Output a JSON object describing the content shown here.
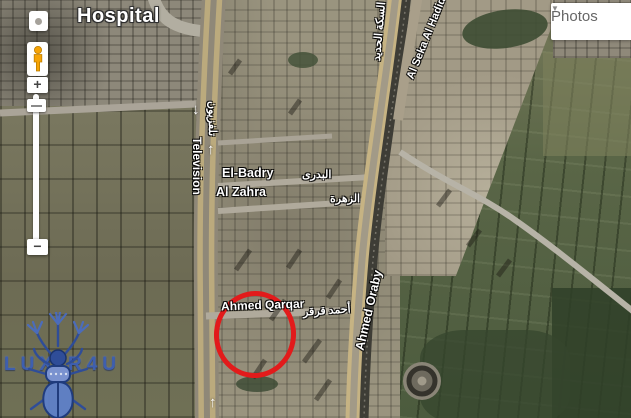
{
  "poi": {
    "hospital": "Hospital"
  },
  "streets": {
    "television_en": "Television",
    "television_ar": "تلفزيون",
    "el_badry_en": "El-Badry",
    "el_badry_ar": "البدرى",
    "al_zahra_en": "Al Zahra",
    "al_zahra_ar": "الزهرة",
    "ahmed_qarqar_en": "Ahmed Qarqar",
    "ahmed_qarqar_ar": "أحمد قرقر",
    "ahmed_oraby_en": "Ahmed Oraby",
    "al_seka_en": "Al Seka Al Hadid",
    "al_seka_ar": "السكة الحديد"
  },
  "arrows": {
    "down": "↓",
    "up": "↑"
  },
  "controls": {
    "zoom_in": "+",
    "zoom_out": "−"
  },
  "photos": {
    "label": "Photos",
    "caret": "▼"
  },
  "watermark": {
    "left": "LUX",
    "right": "R4U",
    "full_name": "LUXOR4U"
  },
  "annotation": {
    "type": "hand-drawn-ellipse",
    "color": "#e21b1b"
  },
  "colors": {
    "annotation_red": "#e21b1b",
    "pegman_orange": "#f6a405",
    "logo_blue": "#3c5fb4",
    "road_yellow": "#c6b383",
    "railway_dark": "#3e3d36"
  }
}
